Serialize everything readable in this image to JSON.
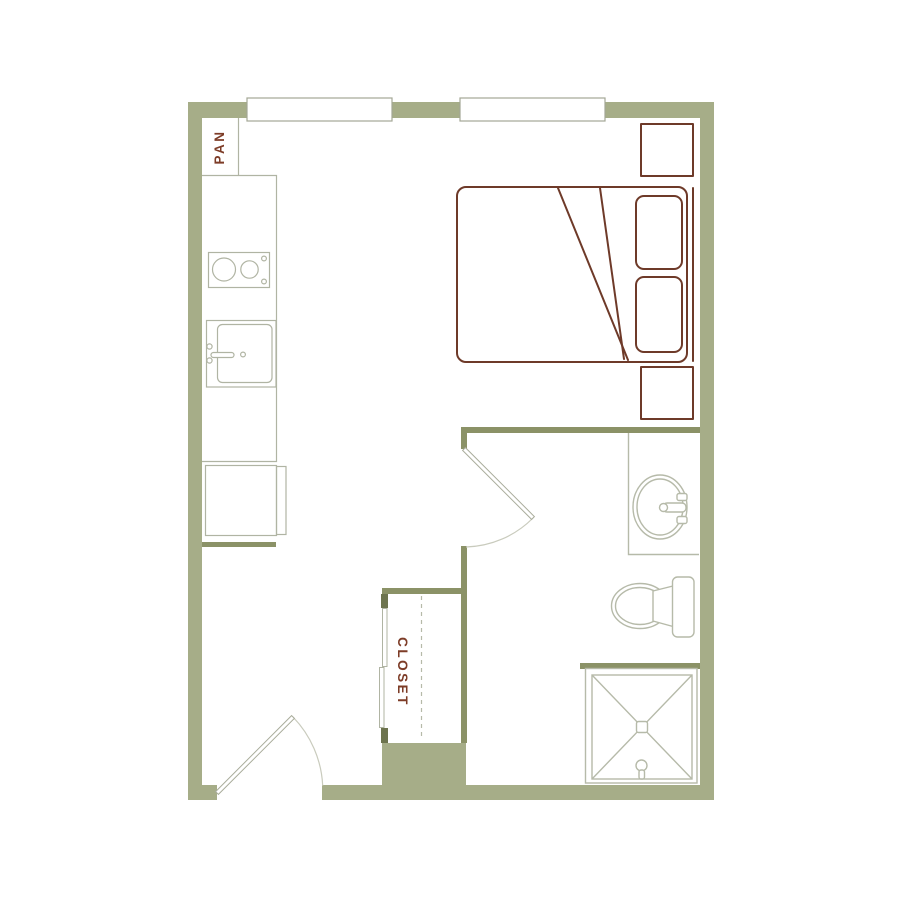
{
  "labels": {
    "pantry": "PAN",
    "closet": "CLOSET"
  },
  "colors": {
    "background": "#ffffff",
    "wall": "#a6ad88",
    "wall-interior": "#8b9267",
    "jamb": "#6d744e",
    "furniture": "#6e3a29",
    "label-text": "#7d3c27",
    "fixture-line": "#b6baa9",
    "counter-line": "#b0b4a3",
    "window-border": "#a3a795",
    "door-line": "#a9ac9b",
    "arc-line": "#c9cbbd"
  }
}
